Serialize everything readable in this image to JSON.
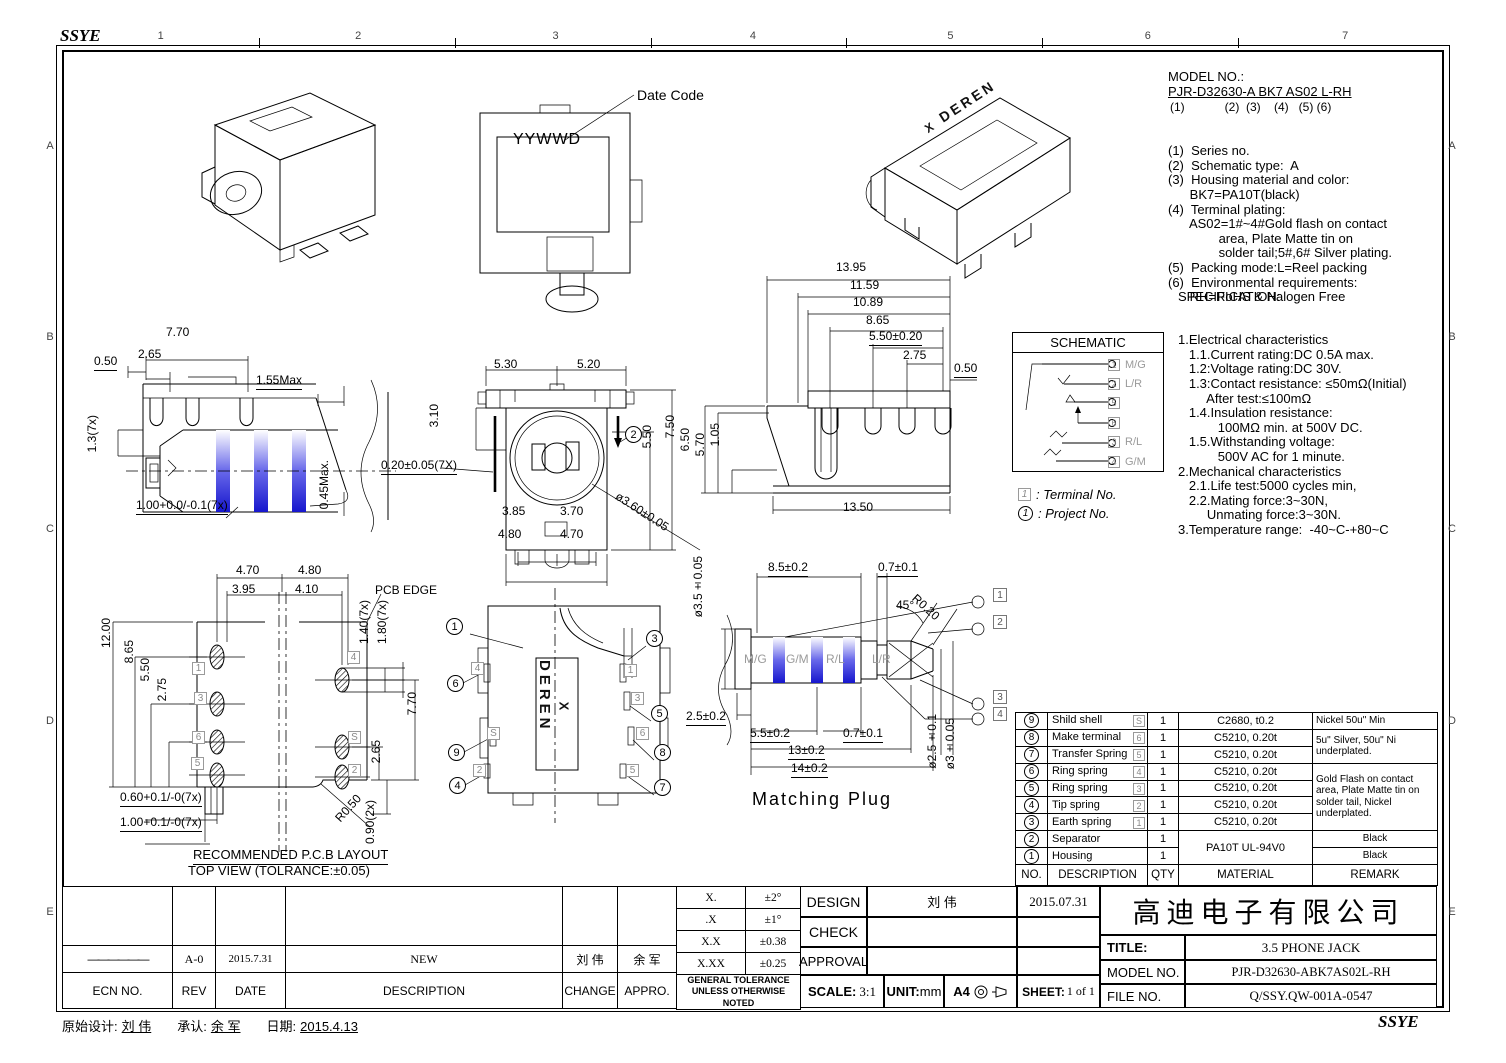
{
  "frame": {
    "logo_top": "SSYE",
    "logo_bottom": "SSYE",
    "columns": [
      "1",
      "2",
      "3",
      "4",
      "5",
      "6",
      "7"
    ],
    "rows": [
      "A",
      "B",
      "C",
      "D",
      "E"
    ],
    "footer": [
      {
        "label": "原始设计:",
        "value": "刘 伟"
      },
      {
        "label": "承认:",
        "value": "余 军"
      },
      {
        "label": "日期:",
        "value": "2015.4.13"
      }
    ]
  },
  "model_note": {
    "title": "MODEL NO.:",
    "code": "PJR-D32630-A BK7 AS02 L-RH",
    "index_line": "(1)            (2)  (3)    (4)   (5) (6)",
    "lines": [
      "(1)  Series no.",
      "(2)  Schematic type:  A",
      "(3)  Housing material and color:",
      "      BK7=PA10T(black)",
      "(4)  Terminal plating:",
      "      AS02=1#~4#Gold flash on contact",
      "              area, Plate Matte tin on",
      "              solder tail;5#,6# Silver plating.",
      "(5)  Packing mode:L=Reel packing",
      "(6)  Environmental requirements:",
      "      RH=RoHS & Halogen Free"
    ]
  },
  "specification": {
    "title": "SPECIFICATION:",
    "lines": [
      "1.Electrical characteristics",
      "   1.1.Current rating:DC 0.5A max.",
      "   1.2:Voltage rating:DC 30V.",
      "   1.3:Contact resistance: ≤50mΩ(Initial)",
      "        After test:≤100mΩ",
      "   1.4.Insulation resistance:",
      "           100MΩ min. at 500V DC.",
      "   1.5.Withstanding voltage:",
      "           500V AC for 1 minute.",
      "2.Mechanical characteristics",
      "   2.1.Life test:5000 cycles min,",
      "   2.2.Mating force:3~30N,",
      "        Unmating force:3~30N.",
      "3.Temperature range:  -40~C-+80~C"
    ]
  },
  "schematic": {
    "title": "SCHEMATIC",
    "rows": [
      {
        "terminal": "1",
        "signal": "M/G"
      },
      {
        "terminal": "2",
        "signal": "L/R"
      },
      {
        "terminal": "5",
        "signal": ""
      },
      {
        "terminal": "6",
        "signal": ""
      },
      {
        "terminal": "3",
        "signal": "R/L"
      },
      {
        "terminal": "4",
        "signal": "G/M"
      }
    ],
    "legend": {
      "box": "1",
      "terminal_text": ": Terminal No.",
      "balloon": "1",
      "project_text": ": Project No."
    }
  },
  "labels": {
    "date_code": "Date Code",
    "yywwd": "YYWWD",
    "brand": "DEREN",
    "brand_x": "X",
    "plug_title": "Matching Plug",
    "pcb_note1": "RECOMMENDED P.C.B LAYOUT",
    "pcb_note2": "TOP VIEW (TOLRANCE:±0.05)",
    "pcb_edge": "PCB EDGE"
  },
  "dims": {
    "side_left": [
      "0.50",
      "7.70",
      "2.65",
      "1.55Max",
      "1.3(7x)",
      "1.00+0.0/-0.1(7x)",
      "0.45Max."
    ],
    "front": [
      "5.30",
      "5.20",
      "3.10",
      "7.50",
      "5.50",
      "0.20±0.05(7X)",
      "3.85",
      "3.70",
      "4.80",
      "4.70",
      "ø3.60±0.05"
    ],
    "side_right": [
      "13.95",
      "11.59",
      "10.89",
      "8.65",
      "5.50±0.20",
      "2.75",
      "0.50",
      "6.50",
      "5.70",
      "1.05",
      "13.50"
    ],
    "pcb": [
      "4.70",
      "4.80",
      "3.95",
      "4.10",
      "1.40(7x)",
      "1.80(7x)",
      "12.00",
      "8.65",
      "5.50",
      "2.75",
      "7.70",
      "2.65",
      "0.60+0.1/-0(7x)",
      "1.00+0.1/-0(7x)",
      "R0.50",
      "0.90(2x)"
    ],
    "plug": [
      "ø3.5±0.05",
      "8.5±0.2",
      "0.7±0.1",
      "45°",
      "R0.20",
      "2.5±0.2",
      "5.5±0.2",
      "0.7±0.1",
      "13±0.2",
      "14±0.2",
      "ø2.5±0.1",
      "ø3±0.05"
    ]
  },
  "front_balloon": "2",
  "pcb_terminals": {
    "left": [
      "1",
      "3",
      "6",
      "5"
    ],
    "right": [
      "4",
      "S",
      "2"
    ]
  },
  "bottom_view": {
    "balloons_left": [
      "1",
      "6",
      "9",
      "4"
    ],
    "balloons_right": [
      "3",
      "5",
      "8",
      "7"
    ],
    "terminals_left": [
      "4",
      "S",
      "2"
    ],
    "terminals_right": [
      "1",
      "3",
      "6",
      "5"
    ]
  },
  "plug": {
    "segments": [
      "M/G",
      "G/M",
      "R/L",
      "L/R"
    ],
    "callouts": [
      "1",
      "2",
      "3",
      "4"
    ]
  },
  "parts_table": {
    "headers": {
      "no": "NO.",
      "description": "DESCRIPTION",
      "qty": "QTY",
      "material": "MATERIAL",
      "remark": "REMARK"
    },
    "rows": [
      {
        "no": "9",
        "description": "Shild shell",
        "terminal": "S",
        "qty": "1",
        "material": "C2680, t0.2",
        "remark": "Nickel 50u\" Min"
      },
      {
        "no": "8",
        "description": "Make terminal",
        "terminal": "6",
        "qty": "1",
        "material": "C5210, 0.20t",
        "remark": "5u\" Silver, 50u\" Ni underplated."
      },
      {
        "no": "7",
        "description": "Transfer Spring",
        "terminal": "5",
        "qty": "1",
        "material": "C5210, 0.20t"
      },
      {
        "no": "6",
        "description": "Ring spring",
        "terminal": "4",
        "qty": "1",
        "material": "C5210, 0.20t",
        "remark": "Gold Flash on contact area, Plate Matte tin on solder tail, Nickel underplated."
      },
      {
        "no": "5",
        "description": "Ring spring",
        "terminal": "3",
        "qty": "1",
        "material": "C5210, 0.20t"
      },
      {
        "no": "4",
        "description": "Tip spring",
        "terminal": "2",
        "qty": "1",
        "material": "C5210, 0.20t"
      },
      {
        "no": "3",
        "description": "Earth spring",
        "terminal": "1",
        "qty": "1",
        "material": "C5210, 0.20t"
      },
      {
        "no": "2",
        "description": "Separator",
        "qty": "1",
        "material": "PA10T UL-94V0",
        "remark": "Black"
      },
      {
        "no": "1",
        "description": "Housing",
        "qty": "1",
        "remark": "Black"
      }
    ]
  },
  "revision": {
    "headers": {
      "ecn": "ECN NO.",
      "rev": "REV",
      "date": "DATE",
      "description": "DESCRIPTION",
      "change": "CHANGE",
      "appro": "APPRO."
    },
    "row": {
      "ecn": "——————",
      "rev": "A-0",
      "date": "2015.7.31",
      "description": "NEW",
      "change": "刘 伟",
      "appro": "余 军"
    }
  },
  "tolerance": {
    "rows": [
      {
        "digits": "X.",
        "tol": "±2°"
      },
      {
        "digits": ".X",
        "tol": "±1°"
      },
      {
        "digits": "X.X",
        "tol": "±0.38"
      },
      {
        "digits": "X.XX",
        "tol": "±0.25"
      }
    ],
    "note1": "GENERAL TOLERANCE",
    "note2": "UNLESS OTHERWISE NOTED"
  },
  "title_block": {
    "design_label": "DESIGN",
    "design_name": "刘 伟",
    "design_date": "2015.07.31",
    "check_label": "CHECK",
    "approval_label": "APPROVAL",
    "scale_label": "SCALE:",
    "scale": "3:1",
    "unit_label": "UNIT:",
    "unit": "mm",
    "paper": "A4",
    "sheet_label": "SHEET:",
    "sheet": "1 of 1"
  },
  "company": {
    "name": "高迪电子有限公司",
    "title_label": "TITLE:",
    "title": "3.5 PHONE JACK",
    "model_label": "MODEL NO.",
    "model": "PJR-D32630-ABK7AS02L-RH",
    "file_label": "FILE NO.",
    "file": "Q/SSY.QW-001A-0547"
  }
}
